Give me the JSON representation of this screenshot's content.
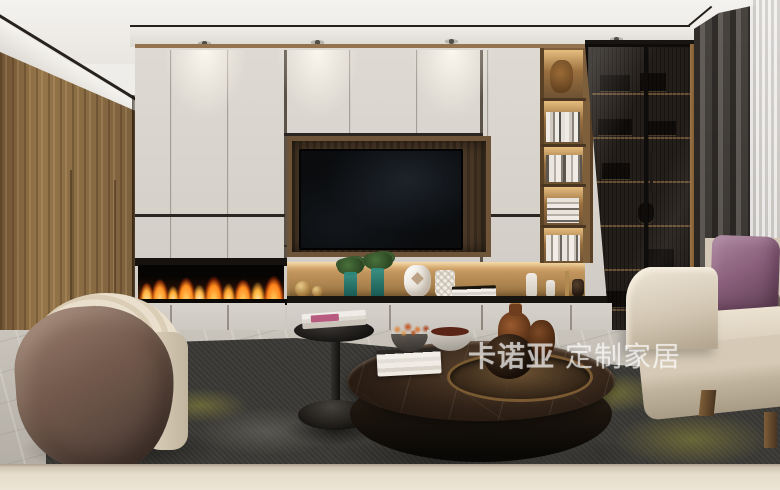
{
  "watermark": {
    "brand": "卡诺亚",
    "tagline": "定制家居",
    "color": "#ffffff",
    "opacity": 0.55
  },
  "scene": {
    "description": "Modern living room render: cream cabinet TV wall with linear fireplace, lit display niche, open bookshelf and smoked-glass cabinet, walnut side wall, beige sofa with purple pillow, barrel armchair, round marble coffee table and black side table on a charcoal rug",
    "objects": [
      "ceiling-downlights",
      "walnut-wood-wall",
      "cream-cabinet-wall",
      "recessed-tv",
      "linear-fireplace",
      "lit-decor-niche",
      "open-bookshelf",
      "glass-display-cabinet",
      "dark-curtain",
      "sheer-curtain",
      "beige-sofa",
      "purple-pillow",
      "barrel-armchair",
      "black-side-table",
      "marble-coffee-table",
      "charcoal-accent-rug",
      "marble-floor"
    ]
  },
  "palette": {
    "cabinet_cream": "#d8d4cd",
    "walnut_wood": "#8a6c44",
    "niche_wood": "#c2955d",
    "flame_orange": "#ff8a1a",
    "accent_purple": "#8a5f7b",
    "sofa_beige": "#ddd3c2",
    "rug_charcoal": "#403f3b",
    "rug_yellow": "#b2aa3e",
    "marble_table_brown": "#33241a",
    "curtain_gray": "#57524d"
  }
}
